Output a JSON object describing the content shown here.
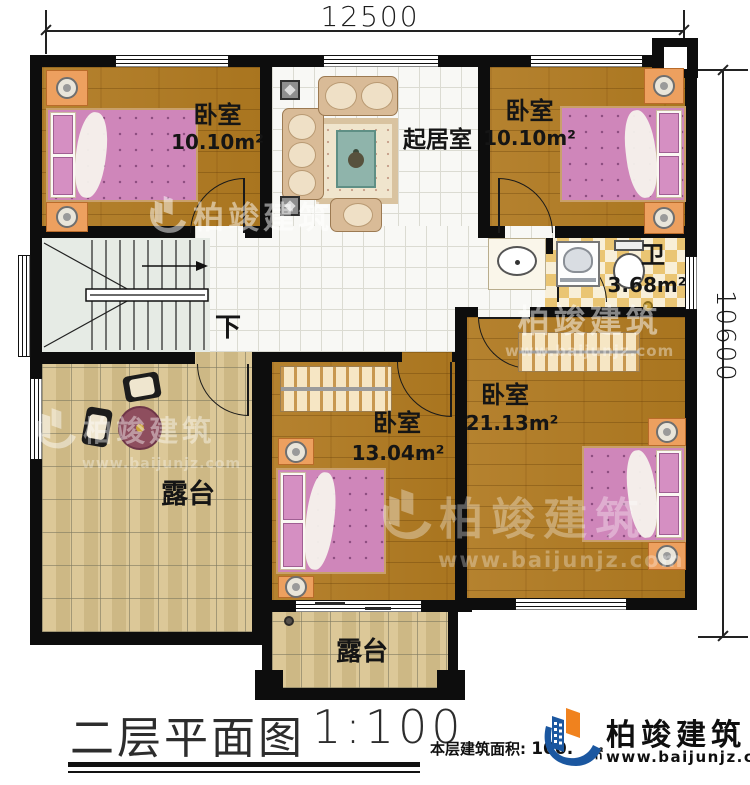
{
  "dimensions": {
    "width": "12500",
    "height": "10600"
  },
  "rooms": {
    "bedroom_top_left": {
      "label": "卧室",
      "area": "10.10m²"
    },
    "living_room": {
      "label": "起居室"
    },
    "bedroom_top_right": {
      "label": "卧室",
      "area": "10.10m²"
    },
    "bathroom": {
      "label": "卫",
      "area": "3.68m²"
    },
    "bedroom_middle": {
      "label": "卧室",
      "area": "13.04m²"
    },
    "bedroom_right": {
      "label": "卧室",
      "area": "21.13m²"
    },
    "terrace_left": {
      "label": "露台"
    },
    "terrace_bottom": {
      "label": "露台"
    }
  },
  "stairs": {
    "down_label": "下"
  },
  "titleblock": {
    "plan_title": "二层平面图",
    "scale": "1:100",
    "area_label": "本层建筑面积:",
    "area_value": "100.",
    "area_unit": "㎡"
  },
  "brand": {
    "name": "柏竣建筑",
    "website": "www.baijunjz.com"
  },
  "colors": {
    "wall": "#0d0d0d",
    "wood_floor": "#b07c2e",
    "tile_floor": "#f8f8f5",
    "stone_floor": "#d8c28c",
    "bath_tile": "#eac573",
    "bed_pink": "#cf86ba",
    "brand_blue": "#1b57a0",
    "brand_orange": "#f0821e"
  }
}
